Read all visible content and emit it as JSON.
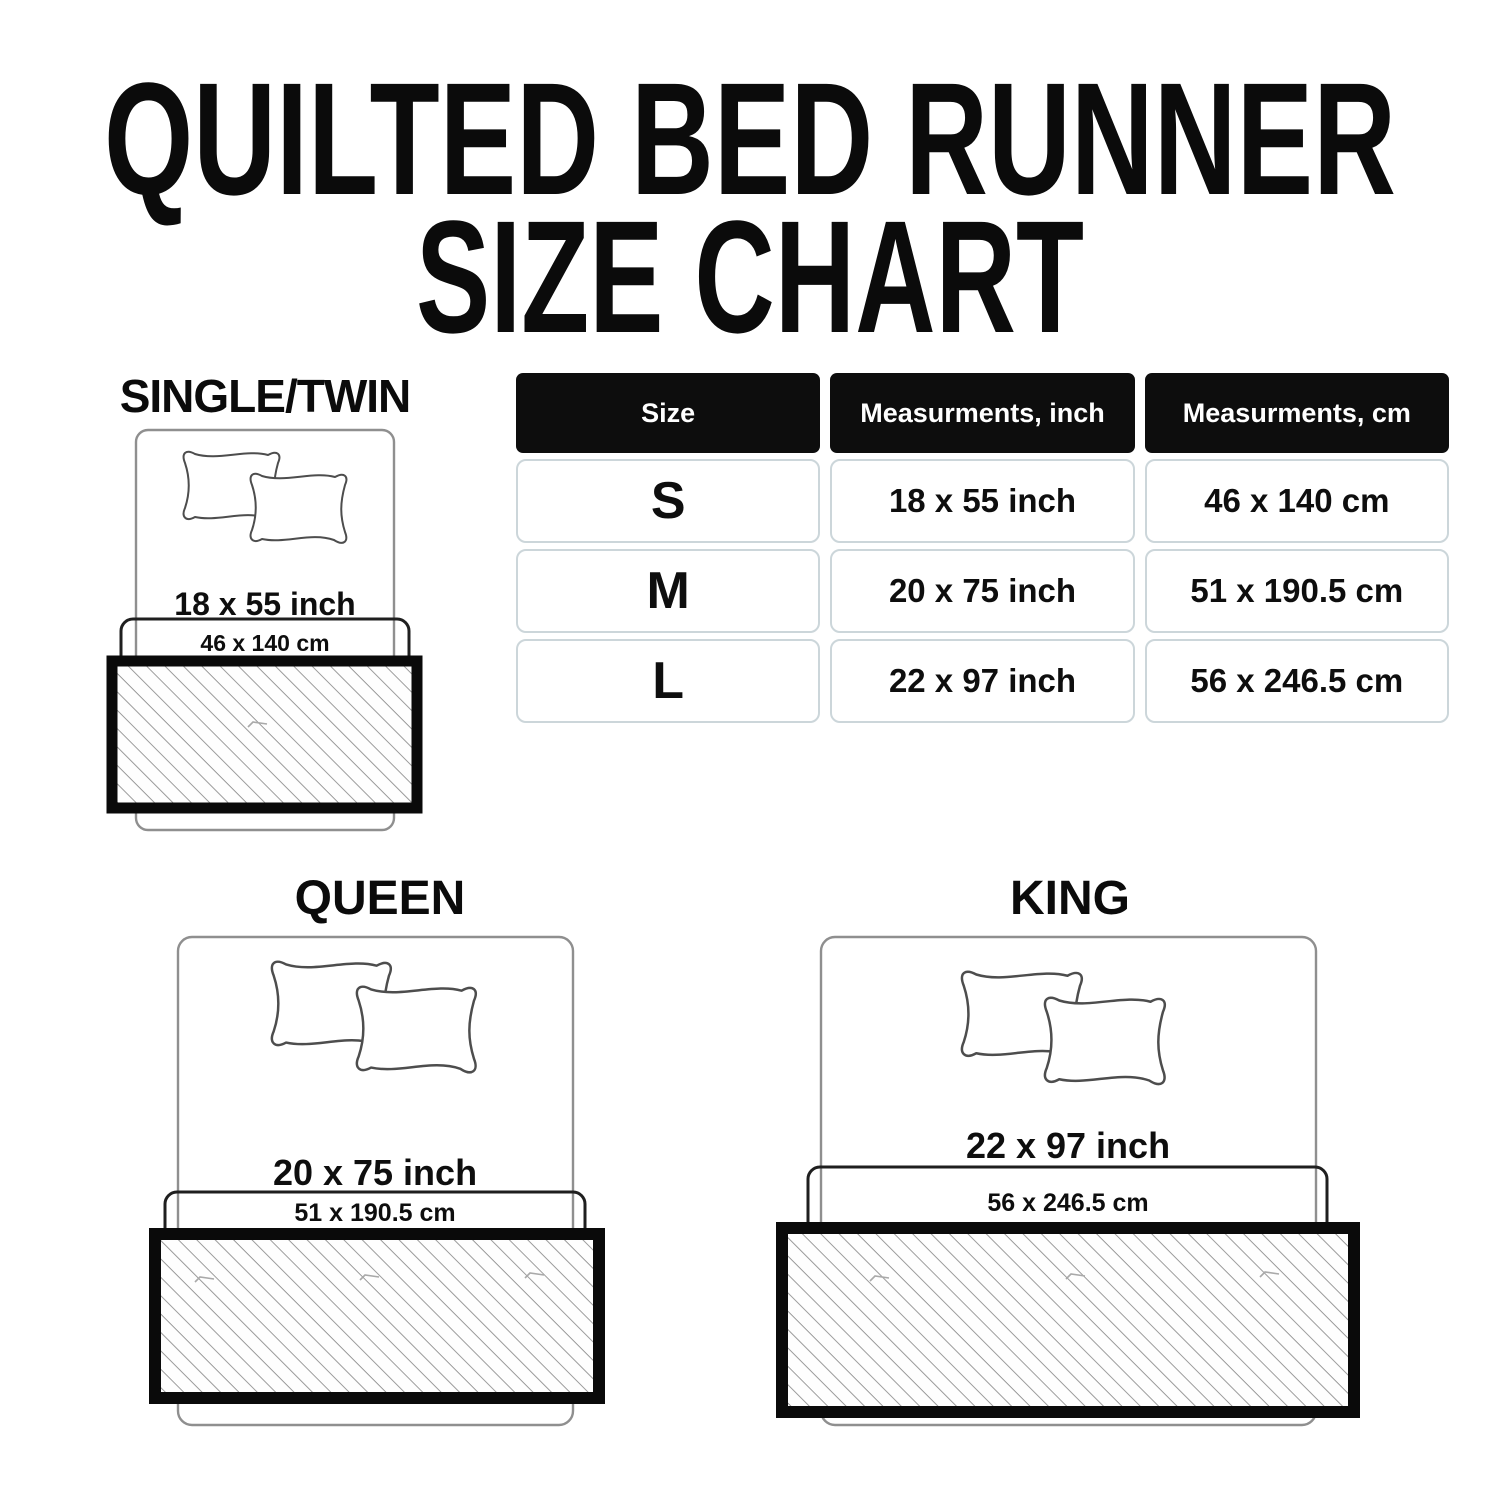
{
  "title": {
    "line1": "QUILTED BED RUNNER",
    "line2": "SIZE CHART"
  },
  "sections": {
    "single": {
      "heading": "SINGLE/TWIN",
      "inch": "18 x 55 inch",
      "cm": "46 x 140 cm"
    },
    "queen": {
      "heading": "QUEEN",
      "inch": "20 x 75 inch",
      "cm": "51 x 190.5 cm"
    },
    "king": {
      "heading": "KING",
      "inch": "22 x 97 inch",
      "cm": "56 x 246.5 cm"
    }
  },
  "table": {
    "headers": [
      "Size",
      "Measurments, inch",
      "Measurments, cm"
    ],
    "rows": [
      [
        "S",
        "18 x 55 inch",
        "46 x 140 cm"
      ],
      [
        "M",
        "20 x 75 inch",
        "51 x 190.5 cm"
      ],
      [
        "L",
        "22 x 97 inch",
        "56 x 246.5 cm"
      ]
    ]
  },
  "colors": {
    "header_bg": "#0d0d0d",
    "header_text": "#ffffff",
    "cell_border": "#ccd6da",
    "text": "#111111",
    "bed_outline": "#8f8f8f",
    "hatch_line": "#8a8a8a",
    "runner_border": "#0a0a0a"
  }
}
